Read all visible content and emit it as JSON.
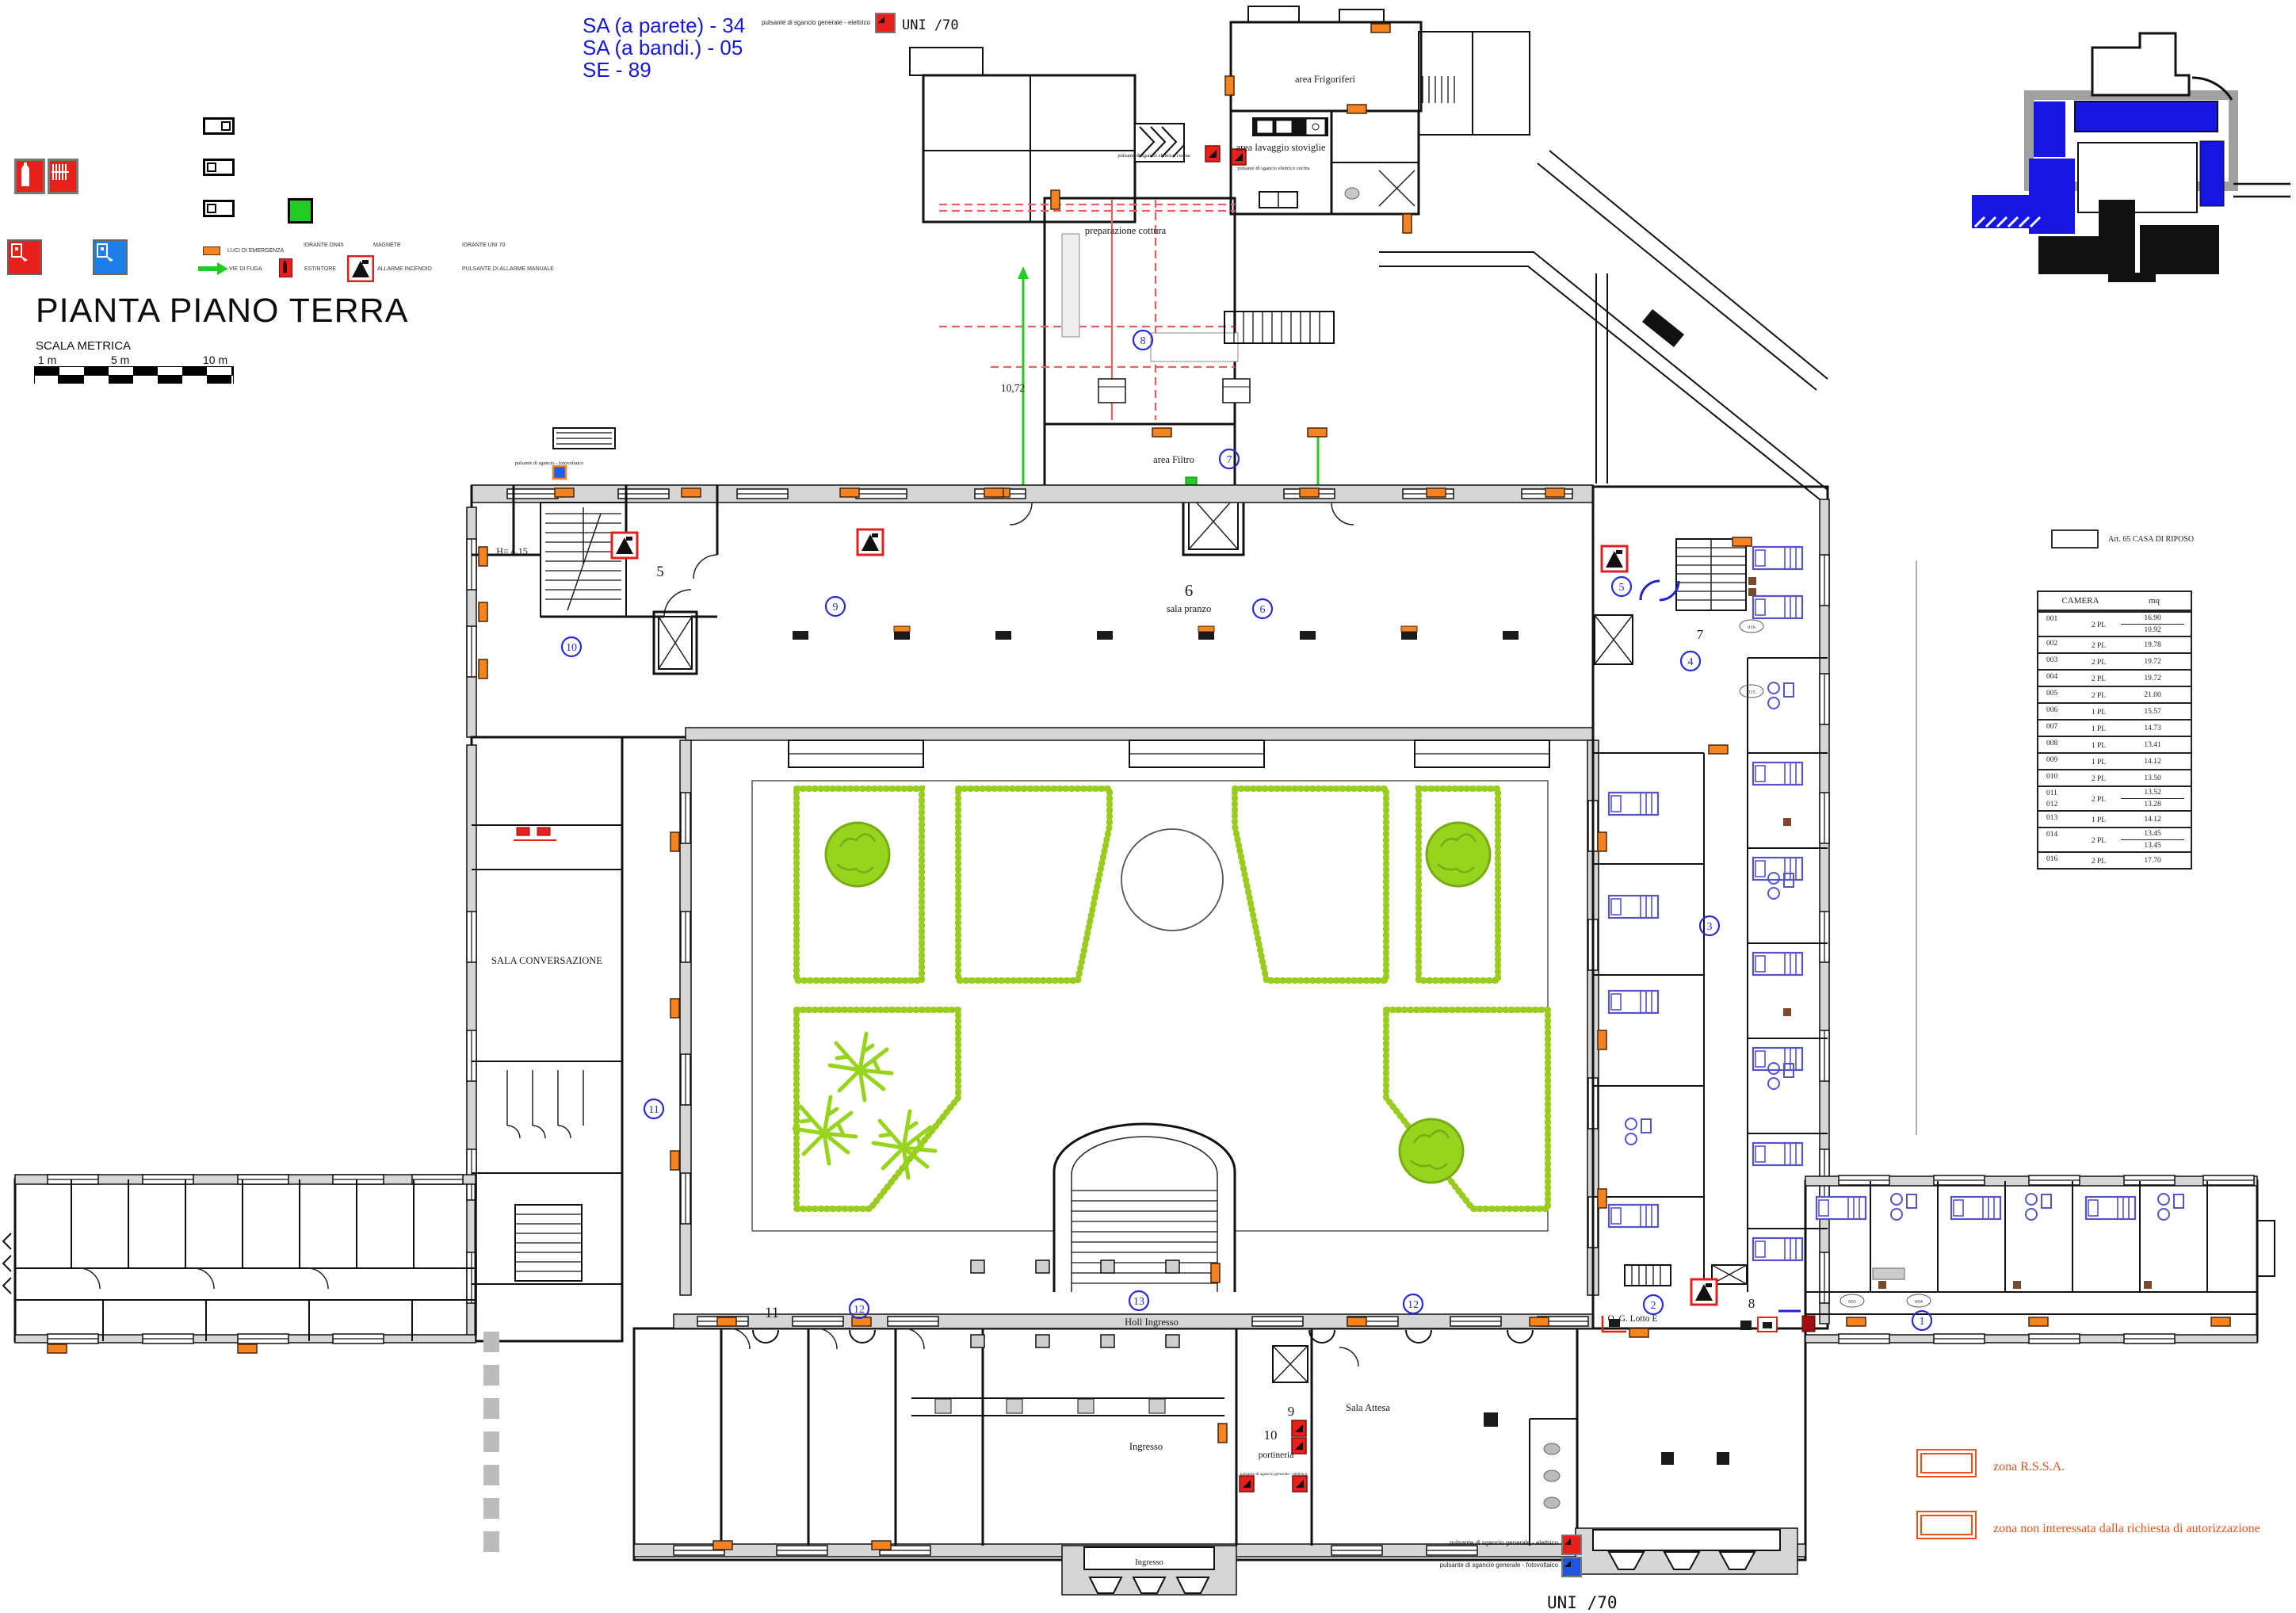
{
  "drawing": {
    "title": "PIANTA PIANO TERRA",
    "scale_label": "SCALA METRICA",
    "scale_ticks": [
      "1 m",
      "5 m",
      "10 m"
    ],
    "uni70_top": "UNI /70",
    "uni70_bottom": "UNI /70"
  },
  "counts": {
    "sa_parete": "SA (a parete) - 34",
    "sa_bandi": "SA (a bandi.) - 05",
    "se": "SE - 89"
  },
  "legend": {
    "luci": "LUCI DI EMERGENZA",
    "vie": "VIE DI FUGA",
    "idrante_dn45": "IDRANTE DN45",
    "estintore": "ESTINTORE",
    "magnete": "MAGNETE",
    "allarme": "ALLARME INCENDIO",
    "idrante_uni70": "IDRANTE UNI 70",
    "pulsante_manuale": "PULSANTE DI ALLARME MANUALE"
  },
  "annotations": {
    "pulsante_generale_elettrico": "pulsante di sgancio generale - elettrico",
    "pulsante_generale_fotovoltaico": "pulsante di sgancio generale - fotovoltaico",
    "pulsante_fotovoltaico": "pulsante di sgancio - fotovoltaico",
    "pulsante_cucina": "pulsante di sgancio elettrico cucina",
    "dim_10_72": "10,72",
    "height_note": "H= 4.15"
  },
  "rooms": {
    "frigoriferi": "area Frigoriferi",
    "lavaggio": "area lavaggio stoviglie",
    "cottura": "preparazione cottura",
    "filtro": "area  Filtro",
    "sala_pranzo": "sala pranzo",
    "sala_conversazione": "SALA CONVERSAZIONE",
    "holl": "Holl Ingresso",
    "ingresso": "Ingresso",
    "ingresso_porch": "Ingresso",
    "portineria": "portineria",
    "sala_attesa": "Sala Attesa",
    "qg_lotto": "Q. G. Lotto E"
  },
  "plan_numbers": {
    "n5": "5",
    "n6": "6",
    "n7": "7",
    "n8": "8",
    "n9": "9",
    "n10": "10",
    "n11": "11"
  },
  "markers": {
    "m1": "1",
    "m2": "2",
    "m3": "3",
    "m4": "4",
    "m5": "5",
    "m6": "6",
    "m7": "7",
    "m8": "8",
    "m9": "9",
    "m10": "10",
    "m11": "11",
    "m12": "12",
    "m12b": "12",
    "m13": "13"
  },
  "room_tags": {
    "t016": "016",
    "t015": "015",
    "t005": "005",
    "t004": "004"
  },
  "zones": {
    "rssa": "zona R.S.S.A.",
    "non_interessata": "zona non interessata dalla richiesta di autorizzazione"
  },
  "riposo_table": {
    "title": "Art. 65  CASA DI RIPOSO",
    "col_camera": "CAMERA",
    "col_mq": "mq",
    "rows": [
      {
        "camera": "001",
        "pl": "2 PL",
        "mq1": "16.90",
        "mq2": "10.92"
      },
      {
        "camera": "002",
        "pl": "2 PL",
        "mq1": "19.78"
      },
      {
        "camera": "003",
        "pl": "2 PL",
        "mq1": "19.72"
      },
      {
        "camera": "004",
        "pl": "2 PL",
        "mq1": "19.72"
      },
      {
        "camera": "005",
        "pl": "2 PL",
        "mq1": "21.00"
      },
      {
        "camera": "006",
        "pl": "1 PL",
        "mq1": "15.57"
      },
      {
        "camera": "007",
        "pl": "1 PL",
        "mq1": "14.73"
      },
      {
        "camera": "008",
        "pl": "1 PL",
        "mq1": "13.41"
      },
      {
        "camera": "009",
        "pl": "1 PL",
        "mq1": "14.12"
      },
      {
        "camera": "010",
        "pl": "2 PL",
        "mq1": "13.50"
      },
      {
        "camera": "011",
        "camera2": "012",
        "pl": "2 PL",
        "mq1": "13.52",
        "mq2": "13.28"
      },
      {
        "camera": "013",
        "pl": "1 PL",
        "mq1": "14.12"
      },
      {
        "camera": "014",
        "pl": "2 PL",
        "mq1": "13.45",
        "mq2": "13.45"
      },
      {
        "camera": "016",
        "pl": "2 PL",
        "mq1": "17.70"
      }
    ]
  },
  "colors": {
    "accent_blue": "#1717d8",
    "marker_blue": "#2a2ad0",
    "hedge_green": "#9acc20",
    "emergency_orange": "#f5831f",
    "alarm_red": "#e8201c",
    "zone_orange": "#e8531a",
    "furniture_blue": "#5454c8",
    "wall_gray": "#d6d6d6"
  }
}
